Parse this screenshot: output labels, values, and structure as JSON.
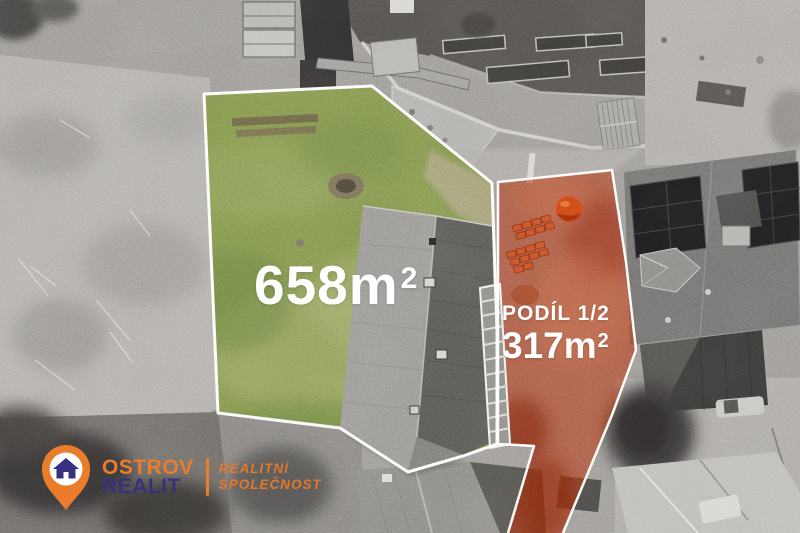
{
  "labels": {
    "main_parcel": {
      "area": "658m",
      "area_exp": "2"
    },
    "share_parcel": {
      "title": "PODÍL 1/2",
      "area": "317m",
      "area_exp": "2"
    }
  },
  "logo": {
    "brand_top": "OSTROV",
    "brand_bottom": "REALIT",
    "tagline_top": "REALITNÍ",
    "tagline_bottom": "SPOLEČNOST"
  },
  "colors": {
    "brand_orange": "#e97d2c",
    "brand_navy": "#38317f",
    "overlay_red": "#b5330f",
    "parcel_outline": "#ffffff",
    "grass_green": "#84974f"
  }
}
